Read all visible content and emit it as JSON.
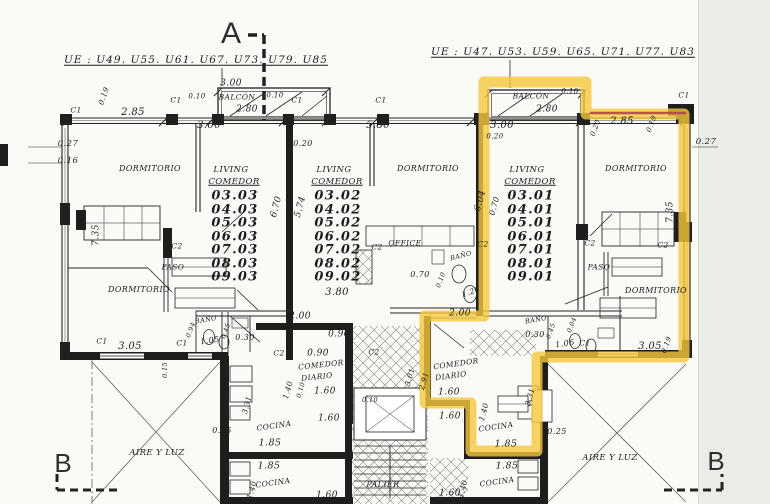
{
  "highlight": {
    "color": "#f5c83c",
    "opacity": 0.8,
    "points": "484,82 586,82 586,114 684,114 684,357 537,357 537,451 471,451 471,403 425,403 425,316 484,316",
    "red_points": "590,113 686,113",
    "red_color": "#b04550"
  },
  "unit_columns": [
    {
      "name": "left",
      "x": 235,
      "y0": 196,
      "dy": 13.5,
      "fs": 13,
      "numbers": [
        "03.03",
        "04.03",
        "05.03",
        "06.03",
        "07.03",
        "08.03",
        "09.03"
      ]
    },
    {
      "name": "middle",
      "x": 338,
      "y0": 196,
      "dy": 13.5,
      "fs": 13,
      "numbers": [
        "03.02",
        "04.02",
        "05.02",
        "06.02",
        "07.02",
        "08.02",
        "09.02"
      ]
    },
    {
      "name": "right-highlighted",
      "x": 531,
      "y0": 196,
      "dy": 13.5,
      "fs": 13,
      "numbers": [
        "03.01",
        "04.01",
        "05.01",
        "06.01",
        "07.01",
        "08.01",
        "09.01"
      ]
    }
  ],
  "labels": [
    {
      "n": "section-marker-a",
      "t": "A",
      "x": 231,
      "y": 34,
      "fs": 30,
      "cls": "mk"
    },
    {
      "n": "section-marker-b-left",
      "t": "B",
      "x": 63,
      "y": 463,
      "fs": 26,
      "cls": "mk"
    },
    {
      "n": "section-marker-b-right",
      "t": "B",
      "x": 716,
      "y": 461,
      "fs": 26,
      "cls": "mk"
    },
    {
      "n": "ue-list-left",
      "t": "UE : U49. U55. U61. U67. U73. U79. U85",
      "x": 196,
      "y": 60,
      "fs": 10.5,
      "cls": "ue"
    },
    {
      "n": "ue-list-right",
      "t": "UE : U47. U53. U59. U65. U71. U77. U83",
      "x": 563,
      "y": 52,
      "fs": 10.5,
      "cls": "ue"
    },
    {
      "n": "dim",
      "t": "0.19",
      "x": 104,
      "y": 96,
      "fs": 7.5,
      "r": -70
    },
    {
      "n": "dim",
      "t": "2.85",
      "x": 133,
      "y": 113,
      "fs": 10
    },
    {
      "n": "dim",
      "t": "3.00",
      "x": 209,
      "y": 126,
      "fs": 10
    },
    {
      "n": "dim",
      "t": "3.00",
      "x": 231,
      "y": 84,
      "fs": 9
    },
    {
      "n": "dim",
      "t": "0.10",
      "x": 197,
      "y": 97,
      "fs": 7
    },
    {
      "n": "room-label-balcon",
      "t": "BALCÓN",
      "x": 237,
      "y": 97,
      "fs": 7.5
    },
    {
      "n": "dim",
      "t": "0.10",
      "x": 275,
      "y": 96,
      "fs": 7
    },
    {
      "n": "dim",
      "t": "2.80",
      "x": 247,
      "y": 110,
      "fs": 9
    },
    {
      "n": "dim",
      "t": "0.20",
      "x": 303,
      "y": 144,
      "fs": 8
    },
    {
      "n": "dim",
      "t": "5.80",
      "x": 378,
      "y": 126,
      "fs": 10
    },
    {
      "n": "column-label",
      "t": "C1",
      "x": 76,
      "y": 110,
      "fs": 7.5
    },
    {
      "n": "column-label",
      "t": "C1",
      "x": 176,
      "y": 100,
      "fs": 7.5
    },
    {
      "n": "column-label",
      "t": "C1",
      "x": 297,
      "y": 100,
      "fs": 7.5
    },
    {
      "n": "column-label",
      "t": "C1",
      "x": 381,
      "y": 100,
      "fs": 7.5
    },
    {
      "n": "column-label",
      "t": "C1",
      "x": 684,
      "y": 95,
      "fs": 7.5
    },
    {
      "n": "room-label-balcon",
      "t": "BALCÓN",
      "x": 531,
      "y": 96,
      "fs": 7.5
    },
    {
      "n": "dim",
      "t": "0.10",
      "x": 570,
      "y": 92,
      "fs": 7
    },
    {
      "n": "dim",
      "t": "2.80",
      "x": 547,
      "y": 110,
      "fs": 9
    },
    {
      "n": "dim",
      "t": "3.00",
      "x": 502,
      "y": 126,
      "fs": 10
    },
    {
      "n": "dim",
      "t": "0.20",
      "x": 495,
      "y": 137,
      "fs": 7
    },
    {
      "n": "dim",
      "t": "0.20",
      "x": 596,
      "y": 128,
      "fs": 7,
      "r": -70
    },
    {
      "n": "dim",
      "t": "2.85",
      "x": 622,
      "y": 122,
      "fs": 10
    },
    {
      "n": "dim",
      "t": "0.19",
      "x": 652,
      "y": 124,
      "fs": 7,
      "r": -70
    },
    {
      "n": "dim",
      "t": "0.27",
      "x": 706,
      "y": 142,
      "fs": 8.5
    },
    {
      "n": "dim",
      "t": "0.27",
      "x": 68,
      "y": 144,
      "fs": 8.5
    },
    {
      "n": "dim",
      "t": "0.16",
      "x": 68,
      "y": 161,
      "fs": 8.5
    },
    {
      "n": "room-label-dormitorio",
      "t": "DORMITORIO",
      "x": 150,
      "y": 169,
      "fs": 8
    },
    {
      "n": "room-label-living",
      "t": "LIVING",
      "x": 231,
      "y": 170,
      "fs": 8.5
    },
    {
      "n": "room-label-comedor",
      "t": "COMEDOR",
      "x": 234,
      "y": 182,
      "fs": 8.5,
      "u": 1
    },
    {
      "n": "dim",
      "t": "7.35",
      "x": 97,
      "y": 235,
      "fs": 9,
      "r": -90
    },
    {
      "n": "column-label",
      "t": "C2",
      "x": 177,
      "y": 246,
      "fs": 7.5
    },
    {
      "n": "room-label-paso",
      "t": "PASO",
      "x": 173,
      "y": 267,
      "fs": 7.5
    },
    {
      "n": "room-label-dormitorio",
      "t": "DORMITORIO",
      "x": 139,
      "y": 290,
      "fs": 8
    },
    {
      "n": "dim",
      "t": "6.70",
      "x": 277,
      "y": 207,
      "fs": 9,
      "r": -75
    },
    {
      "n": "dim",
      "t": "5.74",
      "x": 301,
      "y": 207,
      "fs": 9,
      "r": -75
    },
    {
      "n": "room-label-living",
      "t": "LIVING",
      "x": 334,
      "y": 170,
      "fs": 8.5
    },
    {
      "n": "room-label-comedor",
      "t": "COMEDOR",
      "x": 337,
      "y": 182,
      "fs": 8.5,
      "u": 1
    },
    {
      "n": "room-label-dormitorio",
      "t": "DORMITORIO",
      "x": 428,
      "y": 169,
      "fs": 8
    },
    {
      "n": "room-label-office",
      "t": "OFFICE",
      "x": 405,
      "y": 243,
      "fs": 7.5
    },
    {
      "n": "column-label",
      "t": "C2",
      "x": 377,
      "y": 247,
      "fs": 7.5
    },
    {
      "n": "room-label-bano",
      "t": "BAÑO",
      "x": 461,
      "y": 256,
      "fs": 6.5,
      "r": -15
    },
    {
      "n": "dim",
      "t": "3.80",
      "x": 337,
      "y": 293,
      "fs": 10
    },
    {
      "n": "dim",
      "t": "0.70",
      "x": 420,
      "y": 275,
      "fs": 8
    },
    {
      "n": "dim",
      "t": "0.10",
      "x": 441,
      "y": 280,
      "fs": 6.5,
      "r": -70
    },
    {
      "n": "dim",
      "t": "1.20",
      "x": 471,
      "y": 292,
      "fs": 7.5,
      "r": -20
    },
    {
      "n": "dim",
      "t": "6.04",
      "x": 481,
      "y": 201,
      "fs": 9,
      "r": -75
    },
    {
      "n": "dim",
      "t": "0.70",
      "x": 495,
      "y": 206,
      "fs": 8,
      "r": -75
    },
    {
      "n": "room-label-living",
      "t": "LIVING",
      "x": 527,
      "y": 170,
      "fs": 8.5
    },
    {
      "n": "room-label-comedor",
      "t": "COMEDOR",
      "x": 530,
      "y": 182,
      "fs": 8.5,
      "u": 1
    },
    {
      "n": "room-label-dormitorio",
      "t": "DORMITORIO",
      "x": 636,
      "y": 169,
      "fs": 8
    },
    {
      "n": "column-label",
      "t": "C2",
      "x": 483,
      "y": 244,
      "fs": 7.5
    },
    {
      "n": "column-label",
      "t": "C2",
      "x": 590,
      "y": 243,
      "fs": 7.5
    },
    {
      "n": "column-label",
      "t": "C2",
      "x": 663,
      "y": 245,
      "fs": 7.5
    },
    {
      "n": "room-label-paso",
      "t": "PASO",
      "x": 599,
      "y": 267,
      "fs": 7.5
    },
    {
      "n": "room-label-dormitorio",
      "t": "DORMITORIO",
      "x": 656,
      "y": 291,
      "fs": 8
    },
    {
      "n": "dim",
      "t": "7.35",
      "x": 671,
      "y": 212,
      "fs": 9,
      "r": -90
    },
    {
      "n": "column-label",
      "t": "C1",
      "x": 102,
      "y": 341,
      "fs": 7.5
    },
    {
      "n": "dim",
      "t": "3.05",
      "x": 130,
      "y": 347,
      "fs": 10
    },
    {
      "n": "room-label-bano",
      "t": "BAÑO",
      "x": 206,
      "y": 320,
      "fs": 6.5,
      "r": -10
    },
    {
      "n": "dim",
      "t": "0.94",
      "x": 191,
      "y": 330,
      "fs": 6.5,
      "r": -70
    },
    {
      "n": "dim",
      "t": "1.05",
      "x": 210,
      "y": 341,
      "fs": 8,
      "r": -8
    },
    {
      "n": "dim",
      "t": "0.45",
      "x": 226,
      "y": 331,
      "fs": 6.5,
      "r": -70
    },
    {
      "n": "dim",
      "t": "0.30",
      "x": 245,
      "y": 338,
      "fs": 8
    },
    {
      "n": "column-label",
      "t": "C1",
      "x": 182,
      "y": 343,
      "fs": 7.5
    },
    {
      "n": "dim",
      "t": "0.15",
      "x": 165,
      "y": 370,
      "fs": 6.5,
      "r": -90
    },
    {
      "n": "dim",
      "t": "2.00",
      "x": 300,
      "y": 317,
      "fs": 9
    },
    {
      "n": "dim",
      "t": "0.90",
      "x": 339,
      "y": 335,
      "fs": 9
    },
    {
      "n": "dim",
      "t": "0.90",
      "x": 318,
      "y": 354,
      "fs": 9
    },
    {
      "n": "room-label-comedor-diario",
      "t": "COMEDOR",
      "x": 321,
      "y": 365,
      "fs": 7.5,
      "r": -6
    },
    {
      "n": "room-label-comedor-diario",
      "t": "DIARIO",
      "x": 317,
      "y": 377,
      "fs": 7.5,
      "r": -6
    },
    {
      "n": "dim",
      "t": "1.60",
      "x": 325,
      "y": 392,
      "fs": 9
    },
    {
      "n": "dim",
      "t": "1.40",
      "x": 288,
      "y": 390,
      "fs": 7.5,
      "r": -75
    },
    {
      "n": "dim",
      "t": "0.10",
      "x": 301,
      "y": 390,
      "fs": 6.5,
      "r": -75
    },
    {
      "n": "column-label",
      "t": "C2",
      "x": 279,
      "y": 353,
      "fs": 7.5
    },
    {
      "n": "column-label",
      "t": "C2",
      "x": 374,
      "y": 352,
      "fs": 7.5
    },
    {
      "n": "dim",
      "t": "3.31",
      "x": 247,
      "y": 405,
      "fs": 7.5,
      "r": -75
    },
    {
      "n": "room-label-cocina",
      "t": "COCINA",
      "x": 274,
      "y": 426,
      "fs": 7.5,
      "r": -8
    },
    {
      "n": "dim",
      "t": "1.85",
      "x": 270,
      "y": 443,
      "fs": 9.5
    },
    {
      "n": "dim",
      "t": "1.85",
      "x": 269,
      "y": 466,
      "fs": 9.5
    },
    {
      "n": "room-label-cocina",
      "t": "COCINA",
      "x": 273,
      "y": 483,
      "fs": 7.5,
      "r": -8
    },
    {
      "n": "dim",
      "t": "1.40",
      "x": 252,
      "y": 490,
      "fs": 7.5,
      "r": -75
    },
    {
      "n": "dim",
      "t": "0.25",
      "x": 222,
      "y": 431,
      "fs": 8
    },
    {
      "n": "dim",
      "t": "0.10",
      "x": 370,
      "y": 400,
      "fs": 6.5
    },
    {
      "n": "dim",
      "t": "1.60",
      "x": 329,
      "y": 419,
      "fs": 9
    },
    {
      "n": "dim",
      "t": "1.60",
      "x": 327,
      "y": 496,
      "fs": 9
    },
    {
      "n": "room-label-palier",
      "t": "PALIER",
      "x": 383,
      "y": 485,
      "fs": 8
    },
    {
      "n": "room-label-aire-y-luz",
      "t": "AIRE Y LUZ",
      "x": 157,
      "y": 453,
      "fs": 8.5
    },
    {
      "n": "room-label-aire-y-luz",
      "t": "AIRE Y LUZ",
      "x": 610,
      "y": 458,
      "fs": 8.5
    },
    {
      "n": "dim",
      "t": "2.00",
      "x": 460,
      "y": 314,
      "fs": 9
    },
    {
      "n": "room-label-comedor-diario",
      "t": "COMEDOR",
      "x": 456,
      "y": 364,
      "fs": 7.5,
      "r": -8
    },
    {
      "n": "room-label-comedor-diario",
      "t": "DIARIO",
      "x": 451,
      "y": 376,
      "fs": 7.5,
      "r": -8
    },
    {
      "n": "dim",
      "t": "2.91",
      "x": 424,
      "y": 381,
      "fs": 7.5,
      "r": -75
    },
    {
      "n": "dim",
      "t": "3.01",
      "x": 410,
      "y": 377,
      "fs": 7.5,
      "r": -75
    },
    {
      "n": "dim",
      "t": "1.60",
      "x": 449,
      "y": 393,
      "fs": 9
    },
    {
      "n": "dim",
      "t": "1.60",
      "x": 450,
      "y": 417,
      "fs": 9
    },
    {
      "n": "dim",
      "t": "1.40",
      "x": 484,
      "y": 412,
      "fs": 7.5,
      "r": -75
    },
    {
      "n": "room-label-cocina",
      "t": "COCINA",
      "x": 496,
      "y": 427,
      "fs": 7.5,
      "r": -8
    },
    {
      "n": "dim",
      "t": "1.85",
      "x": 506,
      "y": 444,
      "fs": 9.5
    },
    {
      "n": "dim",
      "t": "1.85",
      "x": 507,
      "y": 466,
      "fs": 9.5
    },
    {
      "n": "room-label-cocina",
      "t": "COCINA",
      "x": 497,
      "y": 482,
      "fs": 7.5,
      "r": -8
    },
    {
      "n": "dim",
      "t": "1.40",
      "x": 463,
      "y": 489,
      "fs": 7.5,
      "r": -75
    },
    {
      "n": "dim",
      "t": "1.60",
      "x": 450,
      "y": 494,
      "fs": 9
    },
    {
      "n": "dim",
      "t": "0.25",
      "x": 557,
      "y": 432,
      "fs": 8
    },
    {
      "n": "dim",
      "t": "3.31",
      "x": 530,
      "y": 397,
      "fs": 7.5,
      "r": -75
    },
    {
      "n": "room-label-bano",
      "t": "BAÑO",
      "x": 536,
      "y": 320,
      "fs": 6.5,
      "r": -10
    },
    {
      "n": "dim",
      "t": "0.30",
      "x": 535,
      "y": 335,
      "fs": 8
    },
    {
      "n": "dim",
      "t": "0.45",
      "x": 551,
      "y": 331,
      "fs": 6.5,
      "r": -70
    },
    {
      "n": "dim",
      "t": "0.04",
      "x": 572,
      "y": 325,
      "fs": 6.5,
      "r": -70
    },
    {
      "n": "dim",
      "t": "1.06",
      "x": 565,
      "y": 344,
      "fs": 8,
      "r": -8
    },
    {
      "n": "column-label",
      "t": "C1",
      "x": 585,
      "y": 343,
      "fs": 7.5
    },
    {
      "n": "dim",
      "t": "3.05",
      "x": 650,
      "y": 347,
      "fs": 10
    },
    {
      "n": "dim",
      "t": "0.19",
      "x": 667,
      "y": 345,
      "fs": 7,
      "r": -70
    }
  ]
}
